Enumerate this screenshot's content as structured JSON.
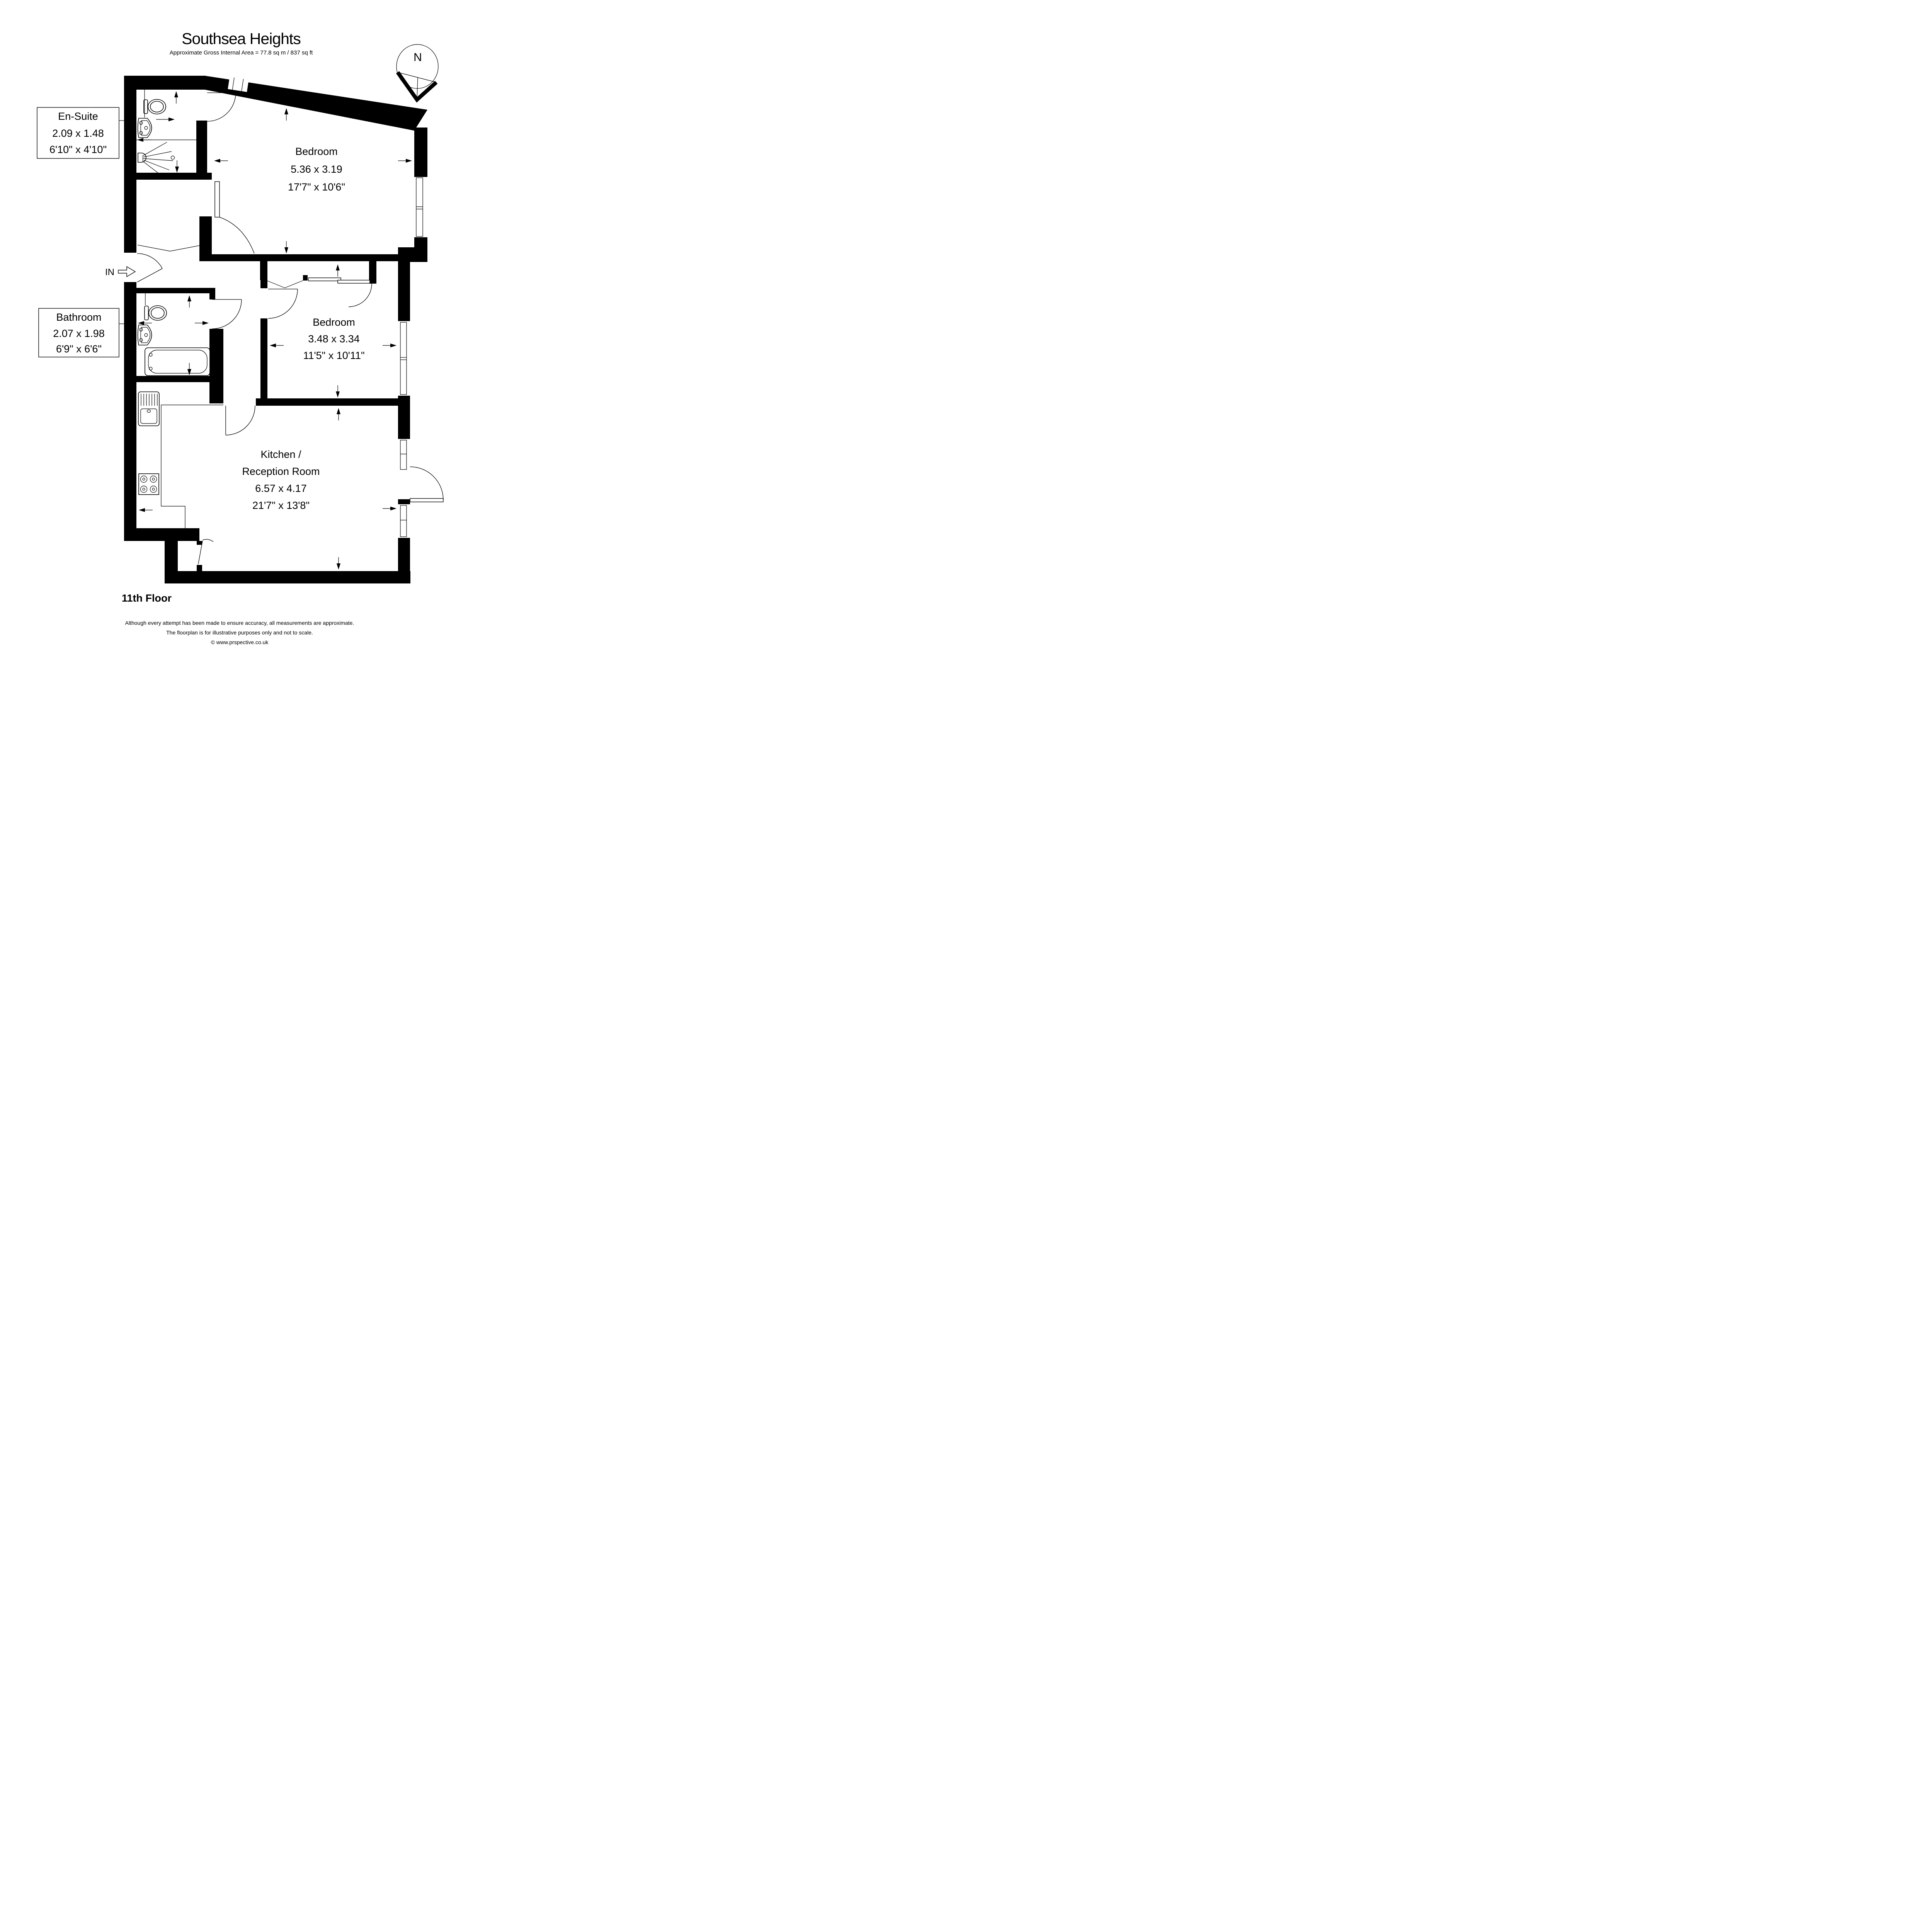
{
  "title": "Southsea Heights",
  "subtitle": "Approximate Gross Internal Area = 77.8 sq m / 837 sq ft",
  "compass": {
    "north_label": "N"
  },
  "entrance_label": "IN",
  "rooms": {
    "ensuite": {
      "name": "En-Suite",
      "metric": "2.09 x 1.48",
      "imperial": "6'10\" x 4'10\""
    },
    "bedroom1": {
      "name": "Bedroom",
      "metric": "5.36 x 3.19",
      "imperial": "17'7\" x 10'6\""
    },
    "bathroom": {
      "name": "Bathroom",
      "metric": "2.07 x 1.98",
      "imperial": "6'9\" x 6'6\""
    },
    "bedroom2": {
      "name": "Bedroom",
      "metric": "3.48 x 3.34",
      "imperial": "11'5\" x 10'11\""
    },
    "kitchen": {
      "name_line1": "Kitchen /",
      "name_line2": "Reception Room",
      "metric": "6.57 x 4.17",
      "imperial": "21'7\" x 13'8\""
    }
  },
  "footer": {
    "floor": "11th Floor",
    "disclaimer_line1": "Although every attempt has been made to ensure accuracy, all measurements are approximate.",
    "disclaimer_line2": "The floorplan is for illustrative purposes only and not to scale.",
    "copyright": "© www.prspective.co.uk"
  }
}
